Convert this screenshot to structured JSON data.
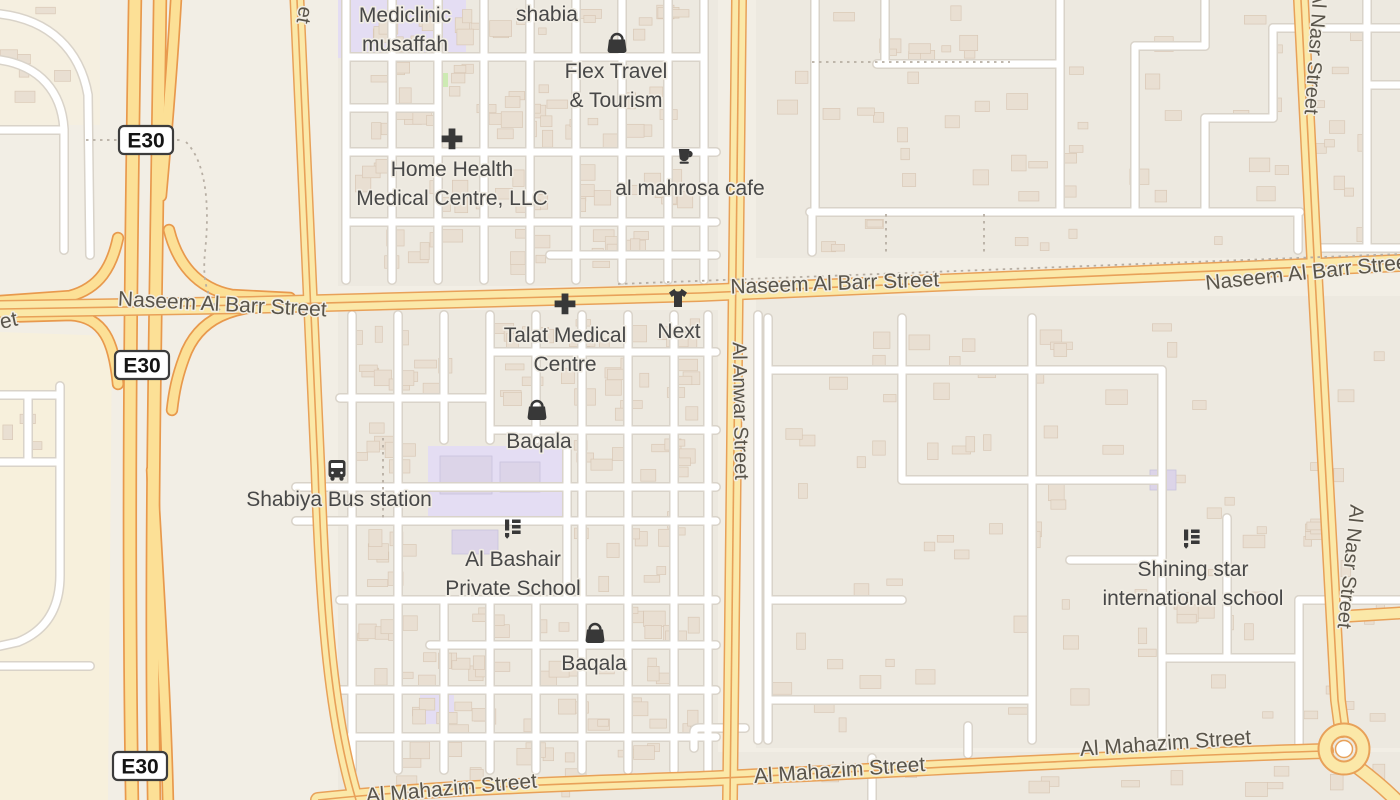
{
  "map": {
    "colors": {
      "background": "#f2eee5",
      "residential": "#ede9e0",
      "sand": "#f7f0dc",
      "school_ground": "#e4ddf3",
      "grass": "#cdeab3",
      "road_white": "#ffffff",
      "road_casing": "#d9d3c9",
      "motorway_fill": "#fce096",
      "motorway_casing": "#e8994d",
      "secondary_fill": "#fbe8a8",
      "secondary_casing": "#e8a159",
      "building": "#e9dfd2",
      "building_stroke": "#d9c8b6",
      "school_building": "#dcd4e8",
      "boundary_dash": "#b7aea3",
      "icon": "#383838",
      "street_text": "#59544a",
      "poi_text": "#484848"
    },
    "shields": [
      {
        "label": "E30",
        "x": 146,
        "y": 140
      },
      {
        "label": "E30",
        "x": 142,
        "y": 365
      },
      {
        "label": "E30",
        "x": 140,
        "y": 766
      }
    ],
    "street_labels": [
      {
        "text": "Naseem Al Barr Street",
        "x": 222,
        "y": 311,
        "angle": 3,
        "size": 21
      },
      {
        "text": "Naseem Al Barr Street",
        "x": 835,
        "y": 290,
        "angle": -2,
        "size": 21
      },
      {
        "text": "Naseem Al Barr Street",
        "x": 1310,
        "y": 279,
        "angle": -6,
        "size": 21
      },
      {
        "text": "Al Anwar Street",
        "x": 734,
        "y": 411,
        "angle": 89,
        "size": 20
      },
      {
        "text": "Al Nasr Street",
        "x": 1309,
        "y": 52,
        "angle": 94,
        "size": 20
      },
      {
        "text": "Al Nasr Street",
        "x": 1344,
        "y": 566,
        "angle": 96,
        "size": 20
      },
      {
        "text": "Al Mahazim Street",
        "x": 840,
        "y": 777,
        "angle": -4,
        "size": 21
      },
      {
        "text": "Al Mahazim Street",
        "x": 1166,
        "y": 750,
        "angle": -4,
        "size": 21
      },
      {
        "text": "Al Mahazim Street",
        "x": 452,
        "y": 795,
        "angle": -5,
        "size": 21
      },
      {
        "text": "et",
        "x": 10,
        "y": 327,
        "angle": -12,
        "size": 21
      },
      {
        "text": "et",
        "x": 298,
        "y": 14,
        "angle": 100,
        "size": 20
      }
    ],
    "pois": [
      {
        "name": "Mediclinic musaffah",
        "icon": null,
        "lines": [
          "Mediclinic",
          "musaffah"
        ],
        "x": 405,
        "y": 22
      },
      {
        "name": "shabia",
        "icon": null,
        "lines": [
          "shabia"
        ],
        "x": 547,
        "y": 21
      },
      {
        "name": "Flex Travel & Tourism",
        "icon": "shop",
        "ix": 617,
        "iy": 43,
        "lines": [
          "Flex Travel",
          "& Tourism"
        ],
        "x": 616,
        "y": 78
      },
      {
        "name": "Home Health Medical Centre, LLC",
        "icon": "medical",
        "ix": 452,
        "iy": 139,
        "lines": [
          "Home Health",
          "Medical Centre, LLC"
        ],
        "x": 452,
        "y": 176
      },
      {
        "name": "al mahrosa cafe",
        "icon": "cafe",
        "ix": 686,
        "iy": 157,
        "lines": [
          "al mahrosa cafe"
        ],
        "x": 690,
        "y": 195
      },
      {
        "name": "Talat Medical Centre",
        "icon": "medical",
        "ix": 565,
        "iy": 304,
        "lines": [
          "Talat Medical",
          "Centre"
        ],
        "x": 565,
        "y": 342
      },
      {
        "name": "Next",
        "icon": "clothes",
        "ix": 678,
        "iy": 298,
        "lines": [
          "Next"
        ],
        "x": 679,
        "y": 338
      },
      {
        "name": "Baqala",
        "icon": "shop",
        "ix": 537,
        "iy": 410,
        "lines": [
          "Baqala"
        ],
        "x": 539,
        "y": 448
      },
      {
        "name": "Shabiya Bus station",
        "icon": "bus",
        "ix": 337,
        "iy": 470,
        "lines": [
          "Shabiya Bus station"
        ],
        "x": 339,
        "y": 506
      },
      {
        "name": "Al Bashair Private School",
        "icon": "school",
        "ix": 513,
        "iy": 529,
        "lines": [
          "Al Bashair",
          "Private School"
        ],
        "x": 513,
        "y": 566
      },
      {
        "name": "Baqala",
        "icon": "shop",
        "ix": 595,
        "iy": 633,
        "lines": [
          "Baqala"
        ],
        "x": 594,
        "y": 670
      },
      {
        "name": "Shining star international school",
        "icon": "school",
        "ix": 1192,
        "iy": 539,
        "lines": [
          "Shining star",
          "international school"
        ],
        "x": 1193,
        "y": 576
      }
    ]
  }
}
